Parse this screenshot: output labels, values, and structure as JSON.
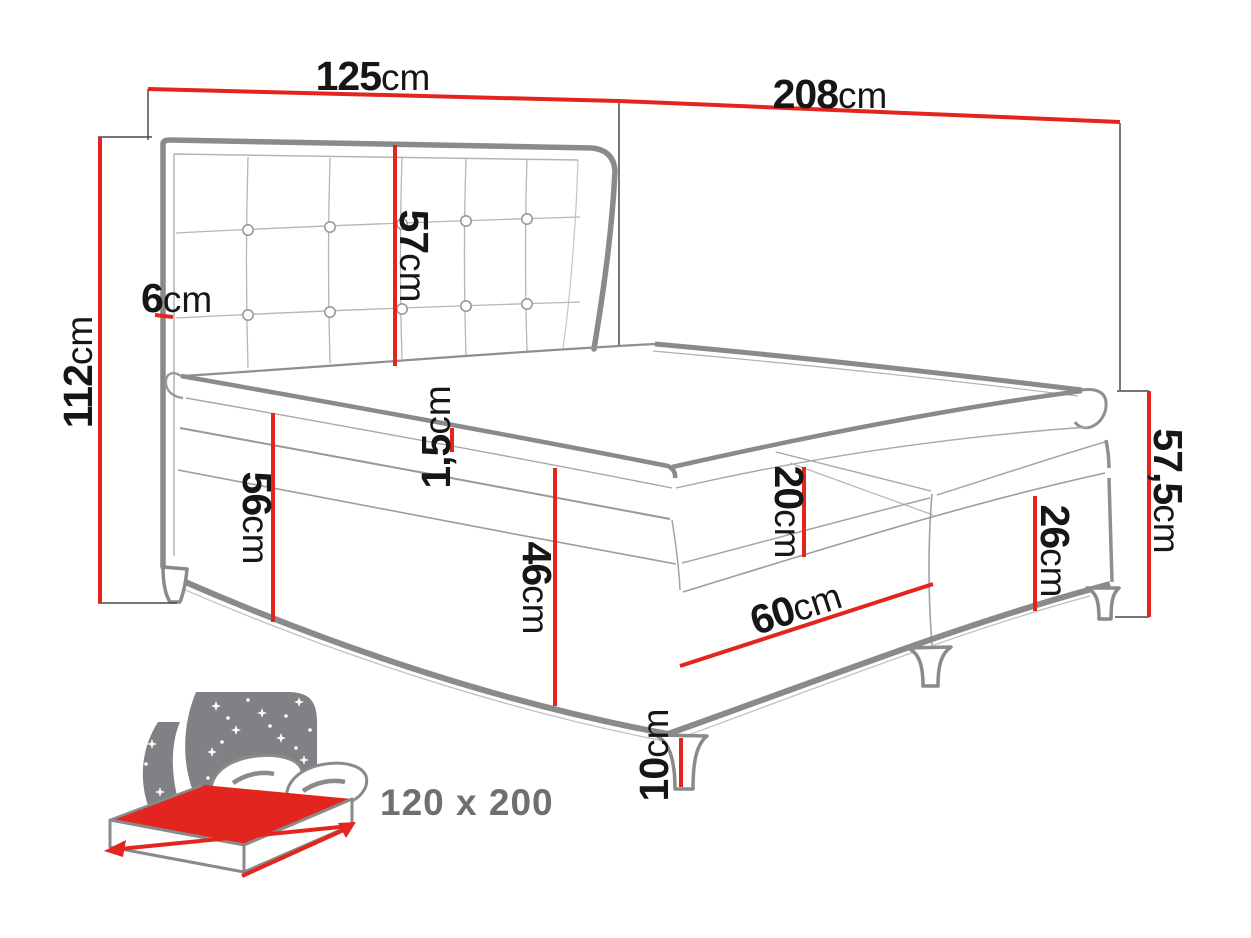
{
  "diagram": {
    "type": "furniture-dimension-diagram",
    "subject": "upholstered boxspring bed with tufted headboard",
    "unit": "cm",
    "dimensions": {
      "headboard_width": {
        "value": "125",
        "unit": "cm"
      },
      "bed_length": {
        "value": "208",
        "unit": "cm"
      },
      "headboard_height": {
        "value": "112",
        "unit": "cm"
      },
      "headboard_side_thickness": {
        "value": "6",
        "unit": "cm"
      },
      "headboard_panel_height": {
        "value": "57",
        "unit": "cm"
      },
      "topper_thickness": {
        "value": "1,5",
        "unit": "cm"
      },
      "side_height_with_mattress": {
        "value": "56",
        "unit": "cm"
      },
      "base_height": {
        "value": "46",
        "unit": "cm"
      },
      "upper_box_height": {
        "value": "20",
        "unit": "cm"
      },
      "lower_box_height": {
        "value": "26",
        "unit": "cm"
      },
      "foot_end_height": {
        "value": "57,5",
        "unit": "cm"
      },
      "box_half_width": {
        "value": "60",
        "unit": "cm"
      },
      "leg_height": {
        "value": "10",
        "unit": "cm"
      }
    },
    "badge": {
      "label": "120 x 200"
    },
    "colors": {
      "dimension_red": "#e2251e",
      "drawing_gray": "#8a8a8a",
      "icon_gray": "#7f8184",
      "badge_text_gray": "#6d6f71",
      "text_black": "#161616",
      "background": "#ffffff"
    }
  }
}
